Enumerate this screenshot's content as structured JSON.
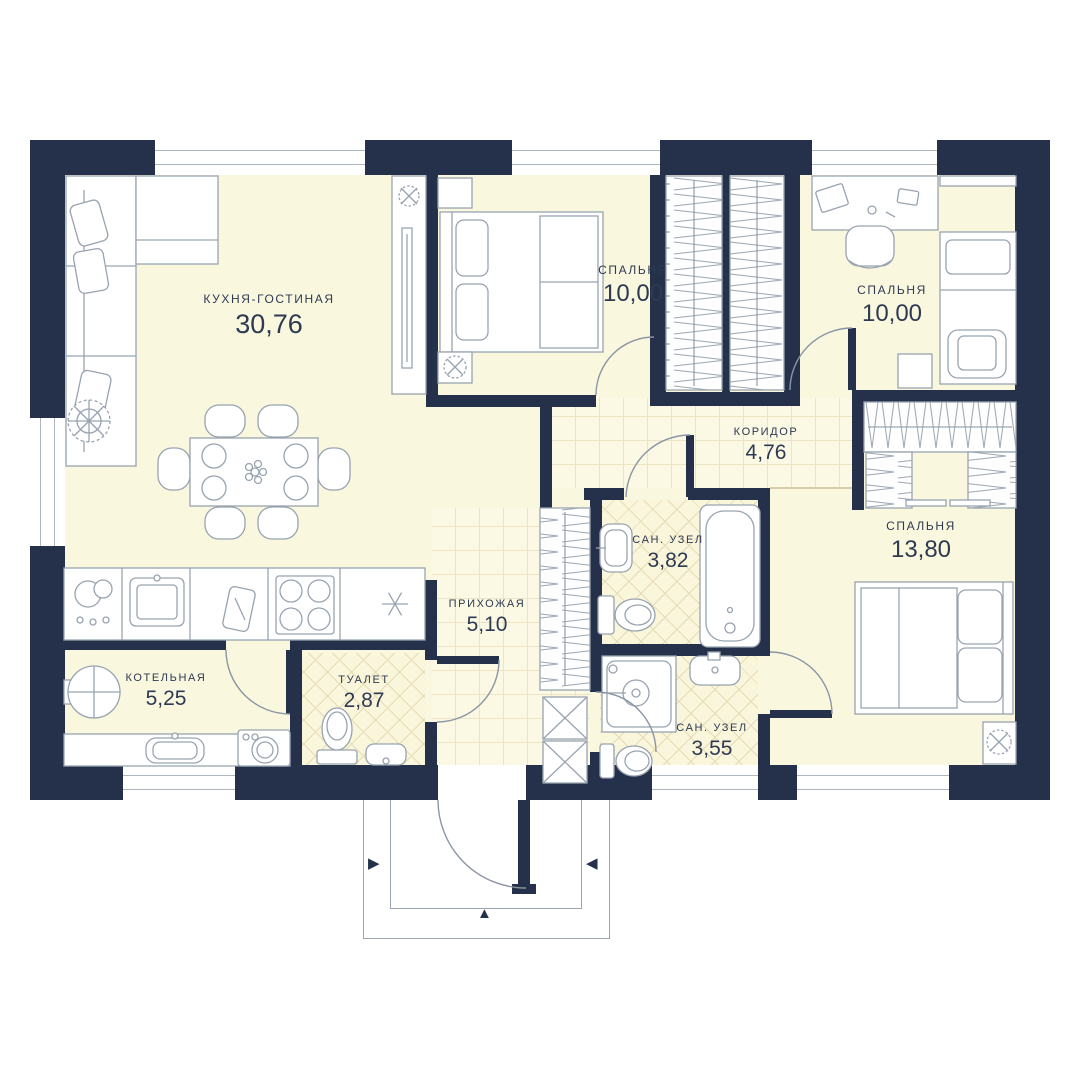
{
  "plan": {
    "rooms": [
      {
        "name": "КУХНЯ-ГОСТИНАЯ",
        "area": "30,76"
      },
      {
        "name": "СПАЛЬНЯ",
        "area": "10,00"
      },
      {
        "name": "СПАЛЬНЯ",
        "area": "10,00"
      },
      {
        "name": "КОРИДОР",
        "area": "4,76"
      },
      {
        "name": "САН. УЗЕЛ",
        "area": "3,82"
      },
      {
        "name": "СПАЛЬНЯ",
        "area": "13,80"
      },
      {
        "name": "ПРИХОЖАЯ",
        "area": "5,10"
      },
      {
        "name": "ТУАЛЕТ",
        "area": "2,87"
      },
      {
        "name": "КОТЕЛЬНАЯ",
        "area": "5,25"
      },
      {
        "name": "САН. УЗЕЛ",
        "area": "3,55"
      }
    ],
    "entrance": {
      "arrow_right": "▶",
      "arrow_left": "◀",
      "arrow_up": "▲"
    },
    "colors": {
      "wall": "#25314a",
      "floor": "#faf7df",
      "tile_line": "#e6dcb6",
      "furniture_stroke": "#98a3b0",
      "label_text": "#2d3a52",
      "background": "#ffffff"
    }
  }
}
